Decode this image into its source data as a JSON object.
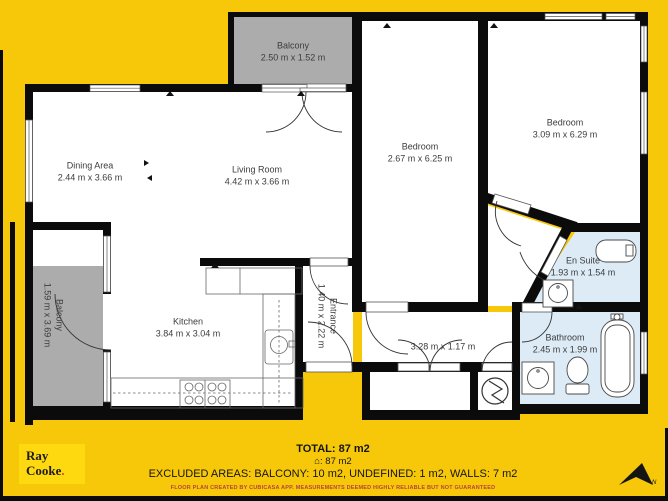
{
  "colors": {
    "background": "#F7C70A",
    "wall": "#0B0B0B",
    "balcony_fill": "#ACACAC",
    "bathroom_fill": "#DCEBF6",
    "room_fill": "#FFFFFF",
    "label_text": "#3C3C3C",
    "disclaimer_red": "#B5453C",
    "logo_box": "#FFD90F",
    "logo_dot_red": "#E8432C"
  },
  "rooms": [
    {
      "id": "balcony-top",
      "name": "Balcony",
      "dims": "2.50 m x 1.52 m"
    },
    {
      "id": "dining-area",
      "name": "Dining Area",
      "dims": "2.44 m x 3.66 m"
    },
    {
      "id": "living-room",
      "name": "Living Room",
      "dims": "4.42 m x 3.66 m"
    },
    {
      "id": "bedroom-1",
      "name": "Bedroom",
      "dims": "2.67 m x 6.25 m"
    },
    {
      "id": "bedroom-2",
      "name": "Bedroom",
      "dims": "3.09 m x 6.29 m"
    },
    {
      "id": "balcony-left",
      "name": "Balcony",
      "dims": "1.59 m x 3.69 m"
    },
    {
      "id": "kitchen",
      "name": "Kitchen",
      "dims": "3.84 m x 3.04 m"
    },
    {
      "id": "entrance",
      "name": "Entrance",
      "dims": "1.40 m x 2.22 m"
    },
    {
      "id": "hallway",
      "name": "",
      "dims": "3.28 m x 1.17 m"
    },
    {
      "id": "en-suite",
      "name": "En Suite",
      "dims": "1.93 m x 1.54 m"
    },
    {
      "id": "bathroom",
      "name": "Bathroom",
      "dims": "2.45 m x 1.99 m"
    }
  ],
  "footer": {
    "total": "TOTAL: 87 m2",
    "area_line": "⌂: 87 m2",
    "excluded": "EXCLUDED AREAS: BALCONY: 10 m2, UNDEFINED: 1 m2, WALLS: 7 m2",
    "disclaimer": "FLOOR PLAN CREATED BY CUBICASA APP. MEASUREMENTS DEEMED HIGHLY RELIABLE BUT NOT GUARANTEED"
  },
  "logo": {
    "line1": "Ray",
    "line2": "Cooke",
    "dot": "."
  },
  "compass": {
    "label": "N"
  }
}
